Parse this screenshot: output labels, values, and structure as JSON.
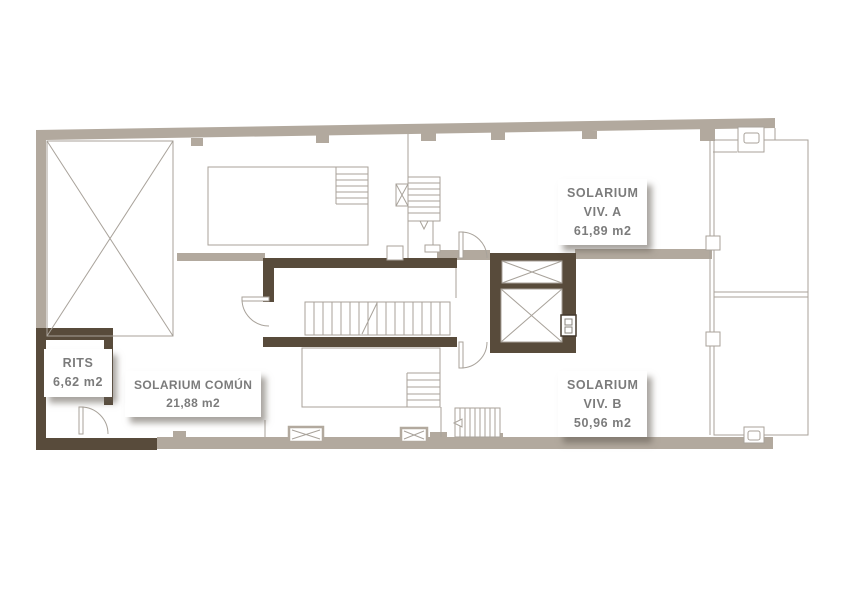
{
  "page": {
    "type": "architectural floor plan — roof/solarium level",
    "background": "#ffffff"
  },
  "colors": {
    "wall_light": "#b2a99e",
    "wall_dark": "#584b3b",
    "thin_line": "#a8a29a",
    "label_text": "#7b7b7b",
    "label_bg": "#ffffff"
  },
  "labels": {
    "solarium_viv_a": {
      "lines": [
        "SOLARIUM",
        "VIV. A",
        "61,89 m2"
      ]
    },
    "solarium_viv_b": {
      "lines": [
        "SOLARIUM",
        "VIV. B",
        "50,96 m2"
      ]
    },
    "solarium_comun": {
      "lines": [
        "SOLARIUM COMÚN",
        "21,88 m2"
      ]
    },
    "rits": {
      "lines": [
        "RITS",
        "6,62 m2"
      ]
    }
  }
}
